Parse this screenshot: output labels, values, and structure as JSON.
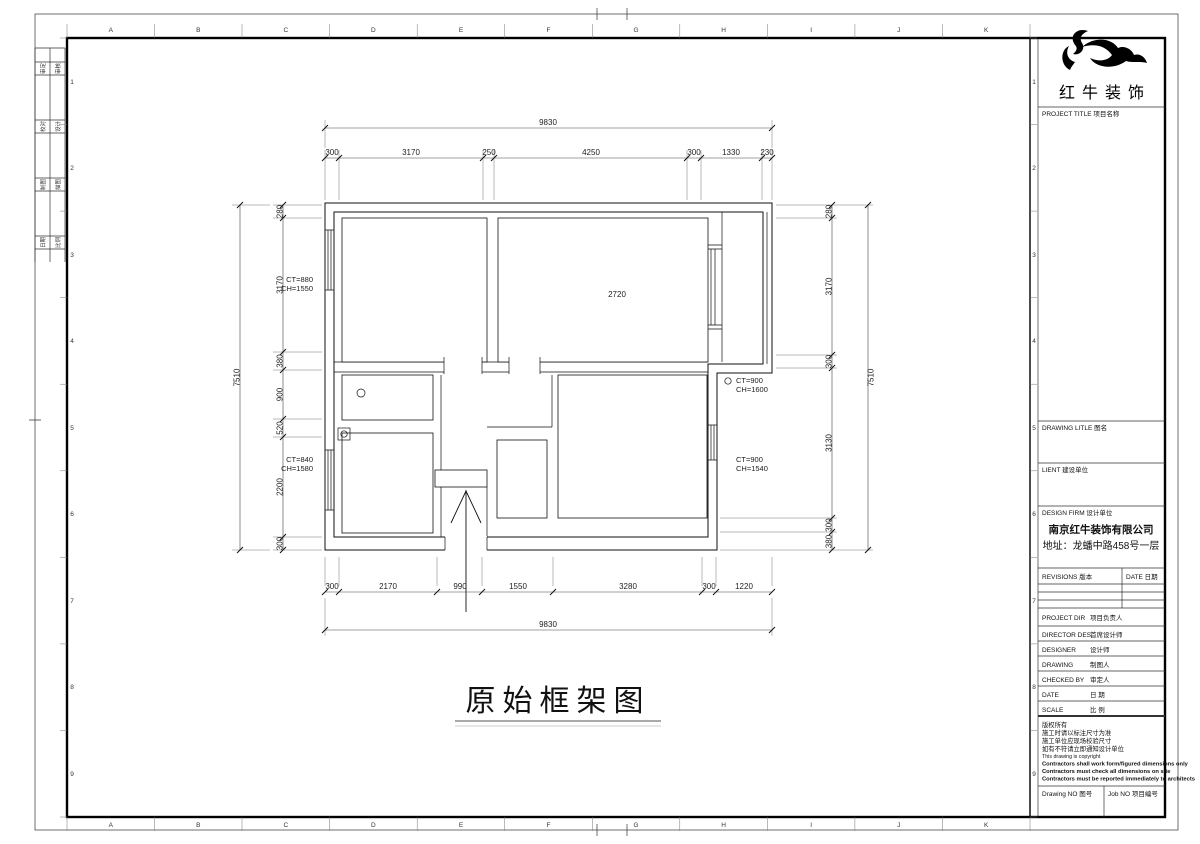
{
  "sheet": {
    "ink_color": "#111111",
    "letters": [
      "A",
      "B",
      "C",
      "D",
      "E",
      "F",
      "G",
      "H",
      "I",
      "J",
      "K"
    ],
    "numbers": [
      "1",
      "2",
      "3",
      "4",
      "5",
      "6",
      "7",
      "8",
      "9"
    ],
    "signoff": [
      {
        "a": "审定",
        "b": "审核"
      },
      {
        "a": "校对",
        "b": "设计"
      },
      {
        "a": "制图",
        "b": "描图"
      },
      {
        "a": "日期",
        "b": "比例"
      }
    ]
  },
  "plan": {
    "title": "原始框架图",
    "room_area_label": "2720",
    "dims": {
      "top_total": "9830",
      "top": [
        "300",
        "3170",
        "250",
        "4250",
        "300",
        "1330",
        "230"
      ],
      "bottom": [
        "300",
        "2170",
        "990",
        "1550",
        "3280",
        "300",
        "1220"
      ],
      "bottom_total": "9830",
      "left": [
        "280",
        "3170",
        "380",
        "900",
        "520",
        "2200",
        "300"
      ],
      "left_total": "7510",
      "right": [
        "280",
        "3170",
        "300",
        "3130",
        "300",
        "380"
      ],
      "right_total": "7510"
    },
    "window_labels": {
      "w1": {
        "ct": "CT=880",
        "ch": "CH=1550"
      },
      "w2": {
        "ct": "CT=840",
        "ch": "CH=1580"
      },
      "w3": {
        "ct": "CT=900",
        "ch": "CH=1600"
      },
      "w4": {
        "ct": "CT=900",
        "ch": "CH=1540"
      }
    }
  },
  "titleblock": {
    "logo_text": "红牛装饰",
    "project_title_label": "PROJECT TITLE  项目名称",
    "drawing_title_label": "DRAWING LITLE  图名",
    "client_label": "LIENT  建设单位",
    "design_firm_label": "DESIGN FIRM  设计单位",
    "firm_name": "南京红牛装饰有限公司",
    "firm_address": "地址：龙蟠中路458号一层",
    "revisions_label": "REVISIONS  版本",
    "date_col_label": "DATE  日期",
    "rows": [
      {
        "label": "PROJECT DIR",
        "cn": "项目负责人"
      },
      {
        "label": "DIRECTOR DES",
        "cn": "首席设计师"
      },
      {
        "label": "DESIGNER",
        "cn": "设计师"
      },
      {
        "label": "DRAWING",
        "cn": "制图人"
      },
      {
        "label": "CHECKED BY",
        "cn": "审定人"
      },
      {
        "label": "DATE",
        "cn": "日  期"
      },
      {
        "label": "SCALE",
        "cn": "比  例"
      }
    ],
    "notes": [
      "版权所有",
      "施工时请以标注尺寸为准",
      "施工单位应现场校验尺寸",
      "如有不符请立即通知设计单位",
      "This drawing is copyright",
      "Contractors shall work form/figured dimensions only",
      "Contractors must check all dimensions on site",
      "Contractors must be reported immediately to architects"
    ],
    "drawing_no_label": "Drawing NO  图号",
    "job_no_label": "Job NO  项目编号"
  }
}
